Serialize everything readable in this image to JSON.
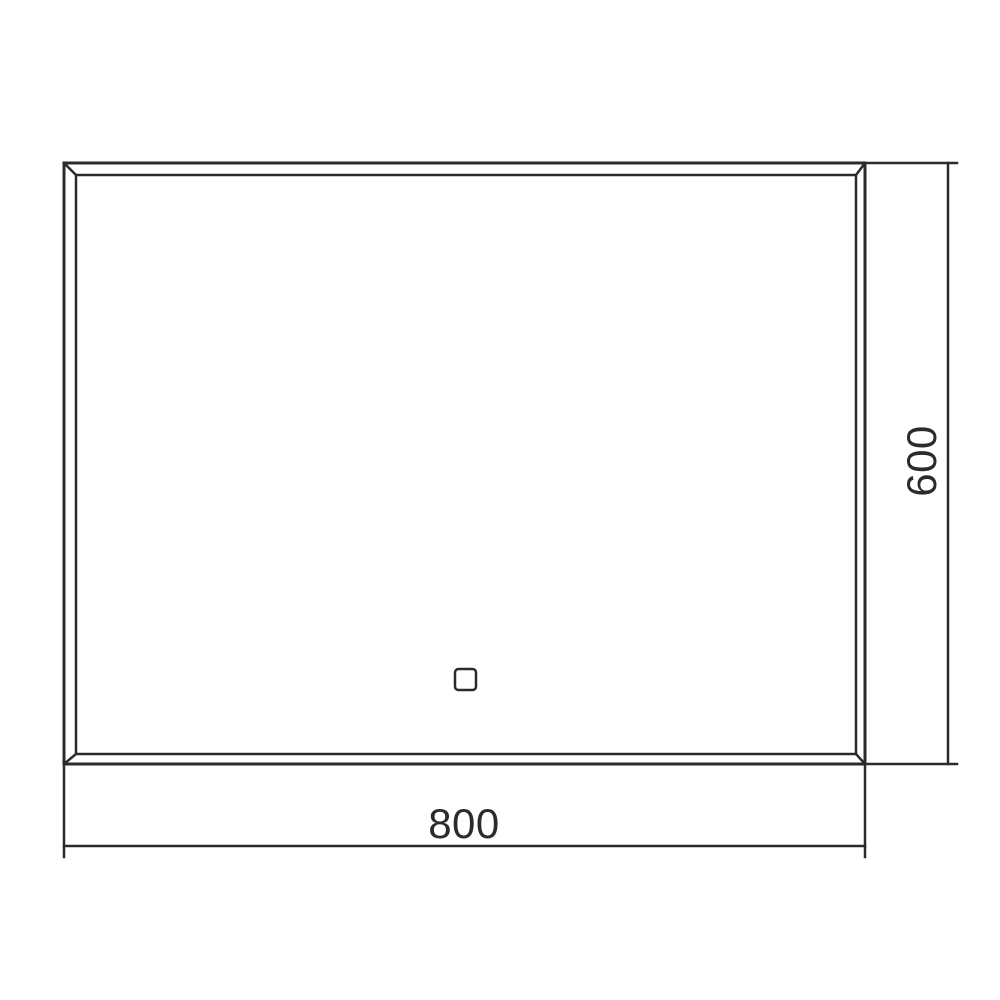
{
  "drawing": {
    "type": "technical-dimension-drawing",
    "subject": "rectangular mirror front view with beveled frame and touch sensor"
  },
  "dimensions": {
    "width_label": "800",
    "height_label": "600"
  },
  "icons": {
    "touch_sensor": "touch-sensor-square"
  },
  "colors": {
    "line": "#2b2b2b",
    "background": "#ffffff"
  }
}
